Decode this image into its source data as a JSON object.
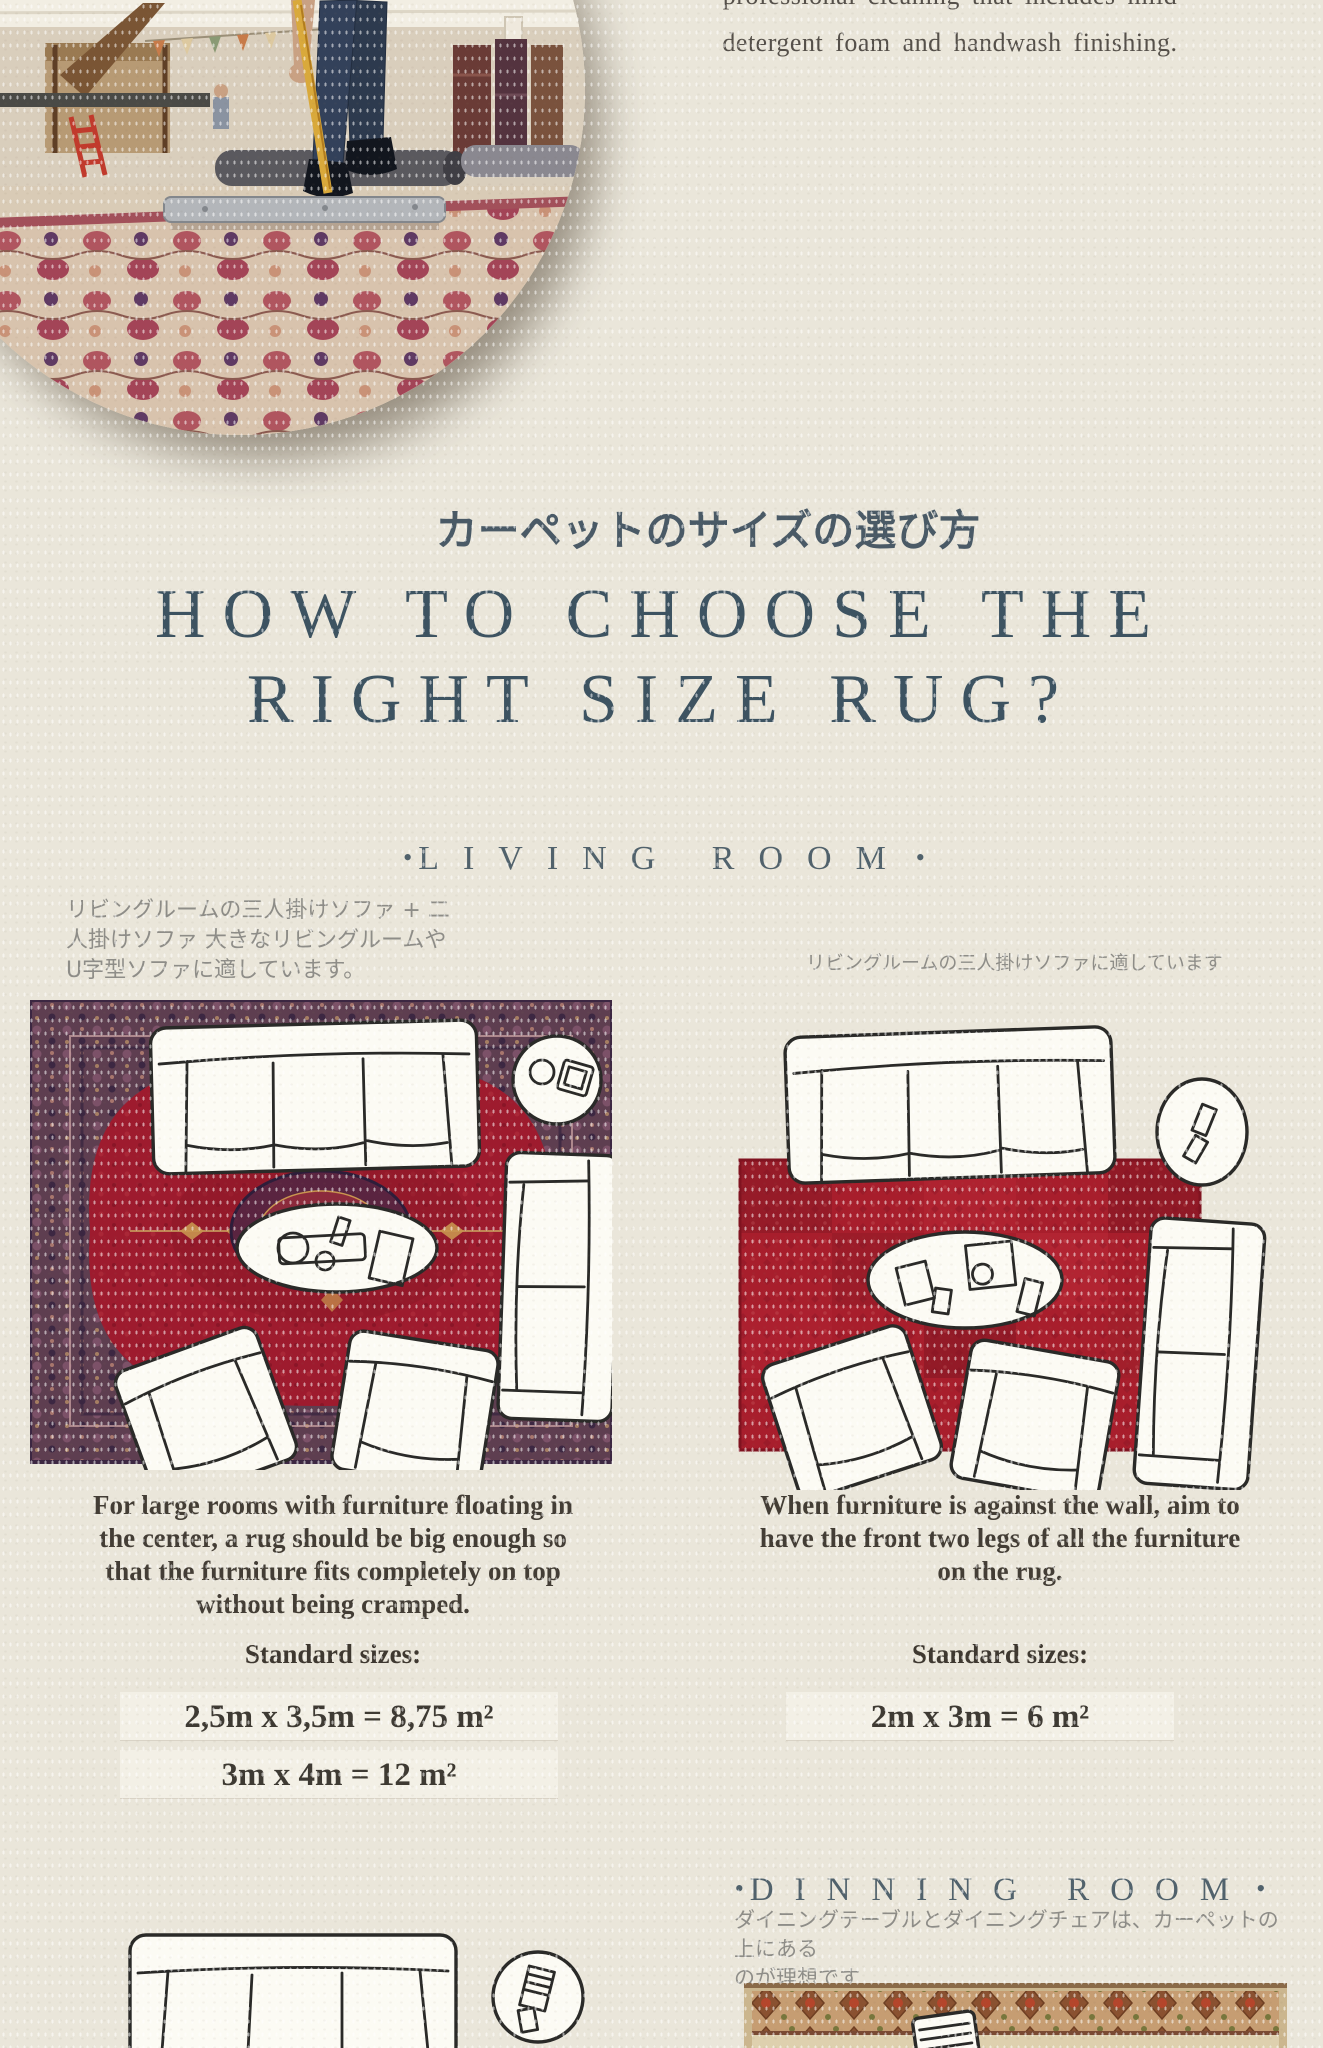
{
  "intro": {
    "line1": "professional cleaning that includes mild",
    "line2": "detergent foam and handwash finishing."
  },
  "title": {
    "jp": "カーペットのサイズの選び方",
    "en_line1": "HOW TO CHOOSE THE",
    "en_line2": "RIGHT SIZE RUG?"
  },
  "bullet": "•",
  "living_room": {
    "label": "LIVING ROOM",
    "left": {
      "jp_line1": "リビングルームの三人掛けソファ + 二",
      "jp_line2": "人掛けソファ 大きなリビングルームや",
      "jp_line3": "U字型ソファに適しています。",
      "caption_line1": "For large rooms with furniture floating in",
      "caption_line2": "the center, a rug should be big enough so",
      "caption_line3": "that the furniture fits completely on top",
      "caption_line4": "without being cramped.",
      "sizes_label": "Standard sizes:",
      "size1": "2,5m x 3,5m = 8,75 m²",
      "size2": "3m x 4m = 12 m²"
    },
    "right": {
      "jp_line1": "リビングルームの三人掛けソファに適しています",
      "caption_line1": "When furniture is against the wall, aim to",
      "caption_line2": "have the front two legs of all the furniture",
      "caption_line3": "on the rug.",
      "sizes_label": "Standard sizes:",
      "size1": "2m x 3m = 6 m²"
    }
  },
  "dinning_room": {
    "label": "DINNING ROOM",
    "jp_line1": "ダイニングテーブルとダイニングチェアは、カーペットの上にある",
    "jp_line2": "のが理想です"
  },
  "colors": {
    "paper": "#eae6da",
    "heading_slate": "#3d5361",
    "jp_heading": "#4a5a66",
    "room_label": "#51626c",
    "jp_text": "#8e8d88",
    "caption": "#433d35",
    "size_strip_bg": "#f3f0e6",
    "rug_red": "#9e1b2e",
    "rug_patch_red": "#a81e2c",
    "rug_border_purple": "#5e3e50",
    "sketch_ink": "#2a2a28"
  }
}
